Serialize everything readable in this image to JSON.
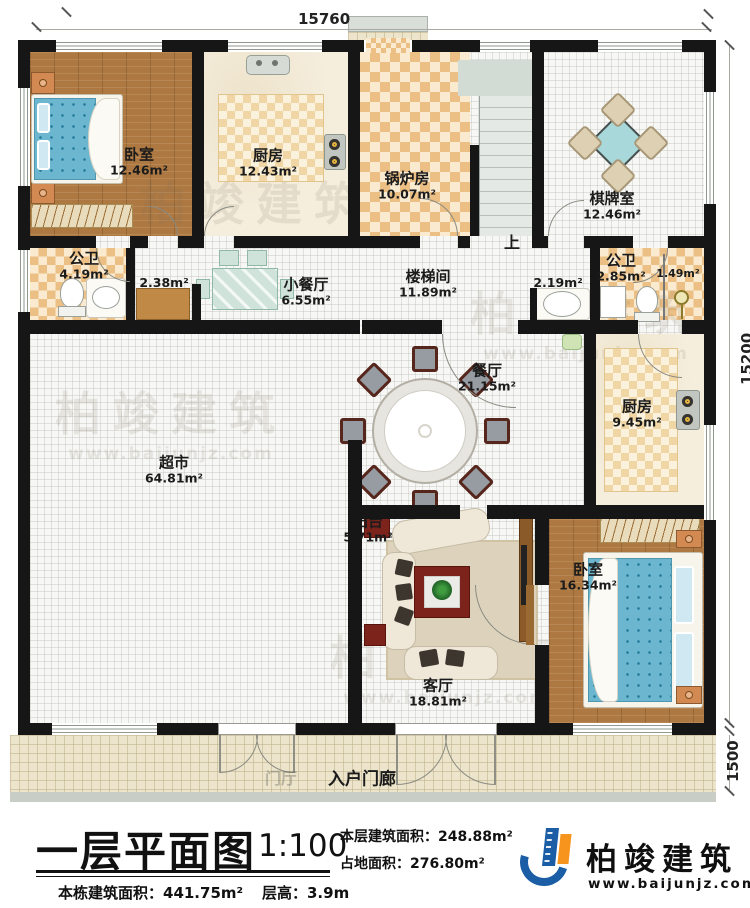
{
  "dimensions": {
    "top": "15760",
    "right_main": "15200",
    "right_porch": "1500"
  },
  "stairs": {
    "up": "上"
  },
  "rooms": {
    "bedroom1": {
      "name": "卧室",
      "area": "12.46m²"
    },
    "kitchen1": {
      "name": "厨房",
      "area": "12.43m²"
    },
    "boiler": {
      "name": "锅炉房",
      "area": "10.07m²"
    },
    "chess": {
      "name": "棋牌室",
      "area": "12.46m²"
    },
    "bath1": {
      "name": "公卫",
      "area": "4.19m²"
    },
    "closet": {
      "area": "2.38m²"
    },
    "dinette": {
      "name": "小餐厅",
      "area": "6.55m²"
    },
    "stairhall": {
      "name": "楼梯间",
      "area": "11.89m²"
    },
    "washnook": {
      "area": "2.19m²"
    },
    "bath2": {
      "name": "公卫",
      "area": "2.85m²"
    },
    "shower": {
      "area": "1.49m²"
    },
    "market": {
      "name": "超市",
      "area": "64.81m²"
    },
    "dining": {
      "name": "餐厅",
      "area": "21.15m²"
    },
    "kitchen2": {
      "name": "厨房",
      "area": "9.45m²"
    },
    "balcony": {
      "name": "阳台",
      "area": "5.71m²"
    },
    "living": {
      "name": "客厅",
      "area": "18.81m²"
    },
    "bedroom2": {
      "name": "卧室",
      "area": "16.34m²"
    },
    "porch": {
      "name": "入户门廊"
    },
    "foyer": {
      "name": "门厅"
    }
  },
  "titleblock": {
    "title": "一层平面图",
    "scale": "1:100",
    "line1": "本层建筑面积：248.88m²",
    "line2": "占地面积：276.80m²",
    "line3": "本栋建筑面积：441.75m²",
    "line4": "层高：3.9m"
  },
  "logo": {
    "name": "柏竣建筑",
    "url": "www.baijunjz.com"
  },
  "watermark": {
    "text": "柏竣建筑",
    "url": "www.baijunjz.com"
  },
  "colors": {
    "wall": "#161616",
    "logo_blue": "#1b5ea6",
    "logo_orange": "#f7941d",
    "mattress": "#6cb7cf",
    "tile": "#ecc084"
  }
}
